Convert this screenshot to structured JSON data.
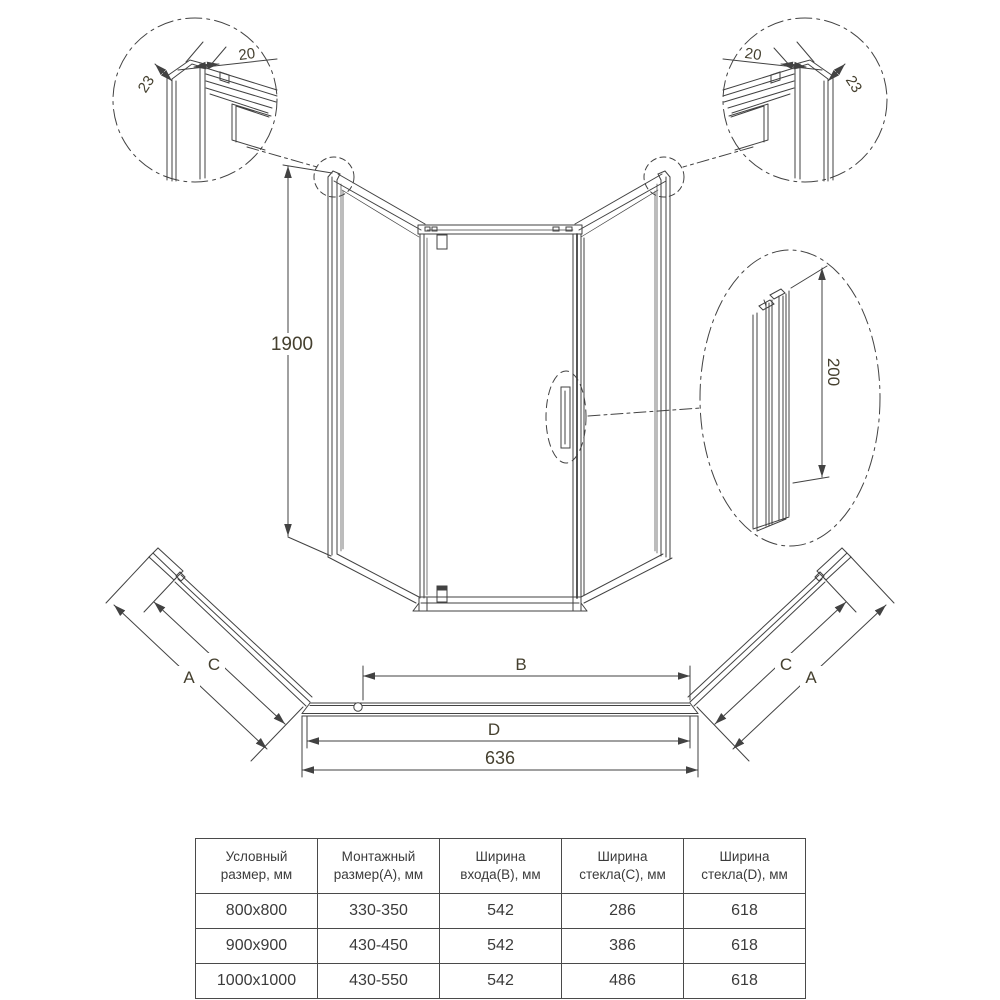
{
  "colors": {
    "line": "#424242",
    "dim_text": "#45402f",
    "table_text": "#3b3b3b",
    "background": "#ffffff"
  },
  "details": {
    "top_left": {
      "profile_width": "20",
      "profile_depth": "23"
    },
    "top_right": {
      "profile_width": "20",
      "profile_depth": "23"
    },
    "handle_profile": {
      "height": "200"
    }
  },
  "elevation": {
    "height": "1900"
  },
  "plan": {
    "mount_label_left": "A",
    "glass_c_label_left": "C",
    "entry_label": "B",
    "glass_d_label": "D",
    "base_width": "636",
    "glass_c_label_right": "C",
    "mount_label_right": "A"
  },
  "table": {
    "headers": [
      "Условный размер, мм",
      "Монтажный размер(A), мм",
      "Ширина входа(B), мм",
      "Ширина стекла(C), мм",
      "Ширина стекла(D), мм"
    ],
    "rows": [
      [
        "800x800",
        "330-350",
        "542",
        "286",
        "618"
      ],
      [
        "900x900",
        "430-450",
        "542",
        "386",
        "618"
      ],
      [
        "1000x1000",
        "430-550",
        "542",
        "486",
        "618"
      ]
    ]
  }
}
